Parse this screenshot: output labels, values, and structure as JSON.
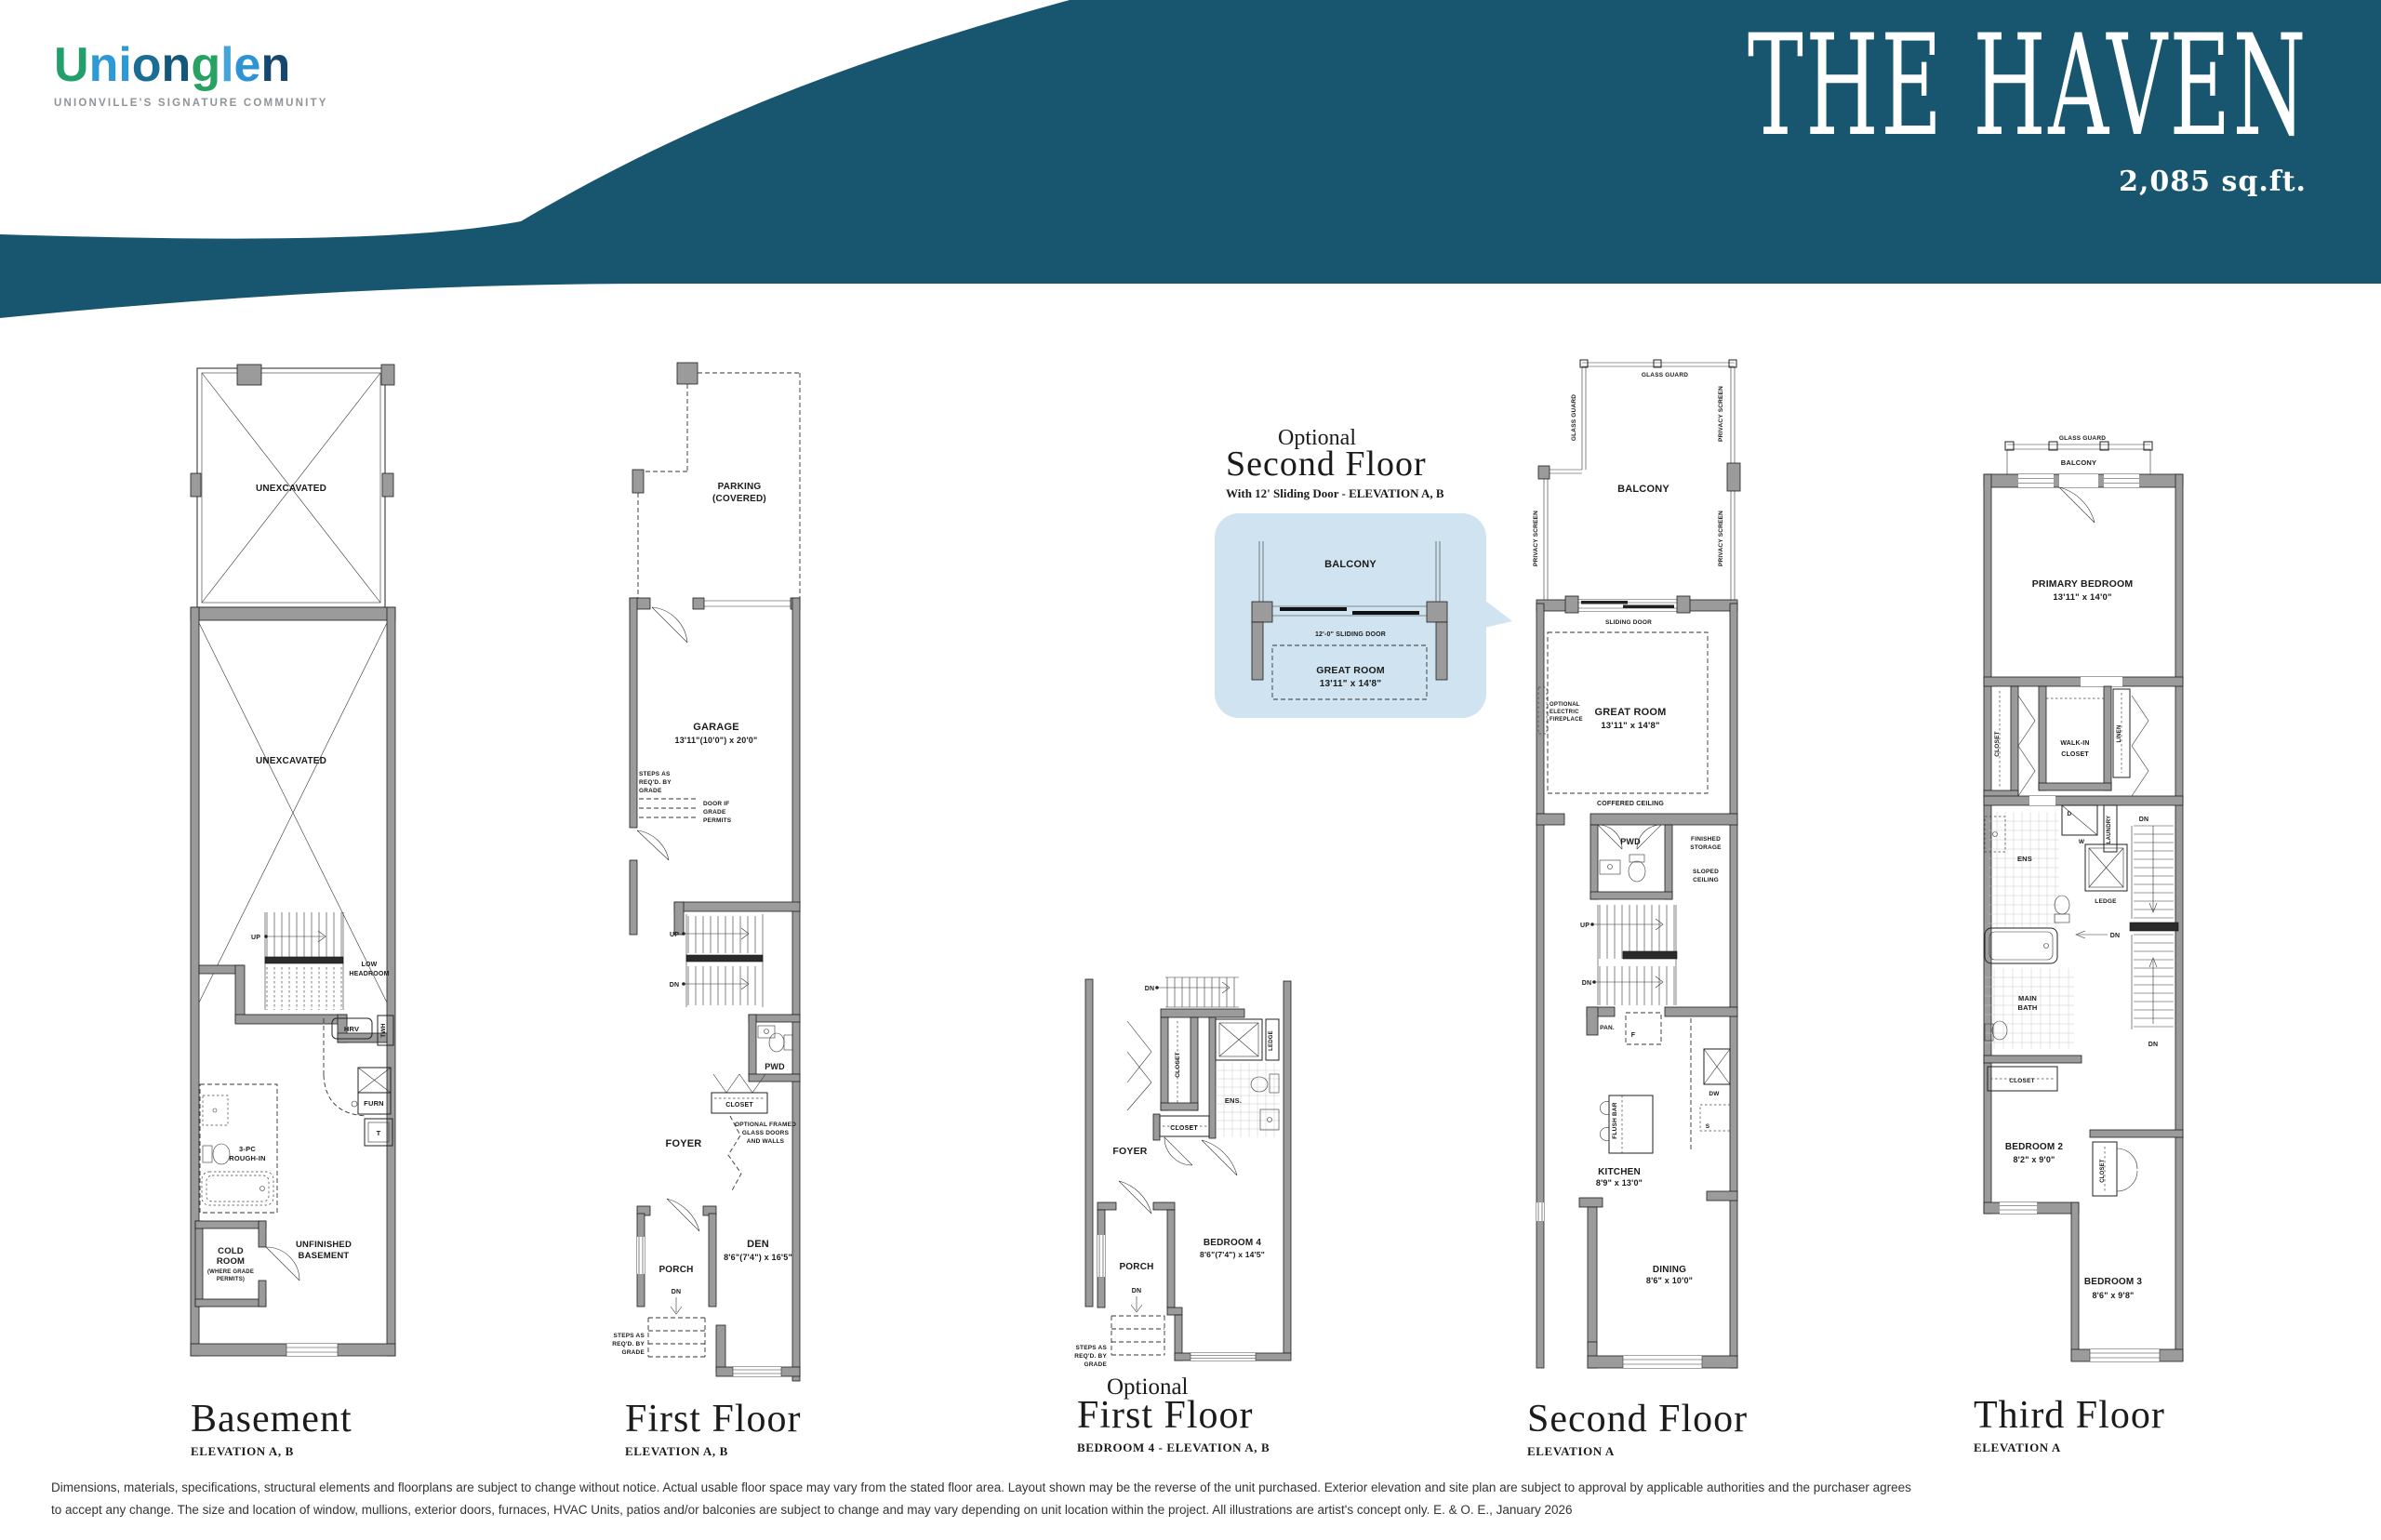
{
  "colors": {
    "header_teal": "#17566E",
    "callout_blue": "#CFE3F0",
    "wall_gray": "#9B9B9B",
    "tagline_gray": "#8E9498",
    "logo_letter_colors": [
      "#22A06B",
      "#2D9AD7",
      "#2D9AD7",
      "#1A6E96",
      "#14577B",
      "#27A263",
      "#45A5DB",
      "#2D93D4",
      "#16486F"
    ]
  },
  "header": {
    "logo_letters": [
      "U",
      "n",
      "i",
      "o",
      "n",
      "g",
      "l",
      "e",
      "n"
    ],
    "tagline": "UNIONVILLE'S SIGNATURE COMMUNITY",
    "title": "THE HAVEN",
    "sqft": "2,085 sq.ft."
  },
  "captions": {
    "basement": {
      "main": "Basement",
      "elev": "ELEVATION A, B"
    },
    "first": {
      "main": "First Floor",
      "elev": "ELEVATION A, B"
    },
    "opt_first": {
      "opt": "Optional",
      "main": "First Floor",
      "elev": "BEDROOM 4 - ELEVATION A, B"
    },
    "opt_second": {
      "opt": "Optional",
      "main": "Second Floor",
      "sub": "With 12' Sliding Door - ELEVATION A, B"
    },
    "second": {
      "main": "Second Floor",
      "elev": "ELEVATION A"
    },
    "third": {
      "main": "Third Floor",
      "elev": "ELEVATION A"
    }
  },
  "plans": {
    "basement": {
      "unex1": "UNEXCAVATED",
      "unex2": "UNEXCAVATED",
      "up": "UP",
      "lowhead1": "LOW",
      "lowhead2": "HEADROOM",
      "hrv": "HRV",
      "twh": "TWH",
      "furn": "FURN",
      "t": "T",
      "rough1": "3-PC",
      "rough2": "ROUGH-IN",
      "cold1": "COLD",
      "cold2": "ROOM",
      "cold3": "(WHERE GRADE",
      "cold4": "PERMITS)",
      "unf1": "UNFINISHED",
      "unf2": "BASEMENT"
    },
    "first": {
      "parking1": "PARKING",
      "parking2": "(COVERED)",
      "garage": "GARAGE",
      "garage_dim": "13'11\"(10'0\") x 20'0\"",
      "stepsA1": "STEPS AS",
      "stepsA2": "REQ'D. BY",
      "stepsA3": "GRADE",
      "door1": "DOOR IF",
      "door2": "GRADE",
      "door3": "PERMITS",
      "up": "UP",
      "dn": "DN",
      "pwd": "PWD",
      "closet": "CLOSET",
      "glass1": "OPTIONAL FRAMED",
      "glass2": "GLASS DOORS",
      "glass3": "AND WALLS",
      "foyer": "FOYER",
      "porch": "PORCH",
      "dn2": "DN",
      "den": "DEN",
      "den_dim": "8'6\"(7'4\") x 16'5\"",
      "stepsB1": "STEPS AS",
      "stepsB2": "REQ'D. BY",
      "stepsB3": "GRADE"
    },
    "opt_first": {
      "dn_top": "DN",
      "closet_v": "CLOSET",
      "ledge": "LEDGE",
      "ens": "ENS.",
      "closet_h": "CLOSET",
      "foyer": "FOYER",
      "porch": "PORCH",
      "dn": "DN",
      "bed4": "BEDROOM 4",
      "bed4_dim": "8'6\"(7'4\") x 14'5\"",
      "steps1": "STEPS AS",
      "steps2": "REQ'D. BY",
      "steps3": "GRADE"
    },
    "opt_second": {
      "balcony": "BALCONY",
      "door": "12'-0\" SLIDING DOOR",
      "gr": "GREAT ROOM",
      "gr_dim": "13'11\" x 14'8\""
    },
    "second": {
      "gg_top": "GLASS GUARD",
      "gg_left": "GLASS GUARD",
      "ps_r1": "PRIVACY SCREEN",
      "ps_r2": "PRIVACY SCREEN",
      "ps_l": "PRIVACY SCREEN",
      "balcony": "BALCONY",
      "sliding": "SLIDING DOOR",
      "fp1": "OPTIONAL",
      "fp2": "ELECTRIC",
      "fp3": "FIREPLACE",
      "gr": "GREAT ROOM",
      "gr_dim": "13'11\" x 14'8\"",
      "coffered": "COFFERED CEILING",
      "pwd": "PWD",
      "fs1": "FINISHED",
      "fs2": "STORAGE",
      "sc1": "SLOPED",
      "sc2": "CEILING",
      "up": "UP",
      "dn": "DN",
      "pan": "PAN.",
      "f": "F",
      "flush": "FLUSH BAR",
      "dw": "DW",
      "s": "S",
      "kitchen": "KITCHEN",
      "kitchen_dim": "8'9\" x 13'0\"",
      "dining": "DINING",
      "dining_dim": "8'6\" x 10'0\""
    },
    "third": {
      "gg": "GLASS GUARD",
      "balcony": "BALCONY",
      "primary": "PRIMARY BEDROOM",
      "primary_dim": "13'11\" x 14'0\"",
      "closet_v": "CLOSET",
      "walkin1": "WALK-IN",
      "walkin2": "CLOSET",
      "linen": "LINEN",
      "laundry": "LAUNDRY",
      "w": "W",
      "d": "D",
      "ens": "ENS",
      "ledge": "LEDGE",
      "dn1": "DN",
      "dn2": "DN",
      "dn3": "DN",
      "mb1": "MAIN",
      "mb2": "BATH",
      "closet_h": "CLOSET",
      "bed2": "BEDROOM 2",
      "bed2_dim": "8'2\" x 9'0\"",
      "closet2": "CLOSET",
      "bed3": "BEDROOM 3",
      "bed3_dim": "8'6\" x 9'8\""
    }
  },
  "disclaimer": {
    "line1": "Dimensions, materials, specifications, structural elements and floorplans are subject to change without notice. Actual usable floor space may vary from the stated floor area. Layout shown may be the reverse of the unit purchased. Exterior elevation and site plan are subject to approval by applicable authorities and the purchaser agrees",
    "line2": "to accept any change. The size and location of window, mullions, exterior doors, furnaces, HVAC Units, patios and/or balconies are subject to change and may vary depending on unit location within the project. All illustrations are artist's concept only. E. & O. E., January 2026"
  }
}
